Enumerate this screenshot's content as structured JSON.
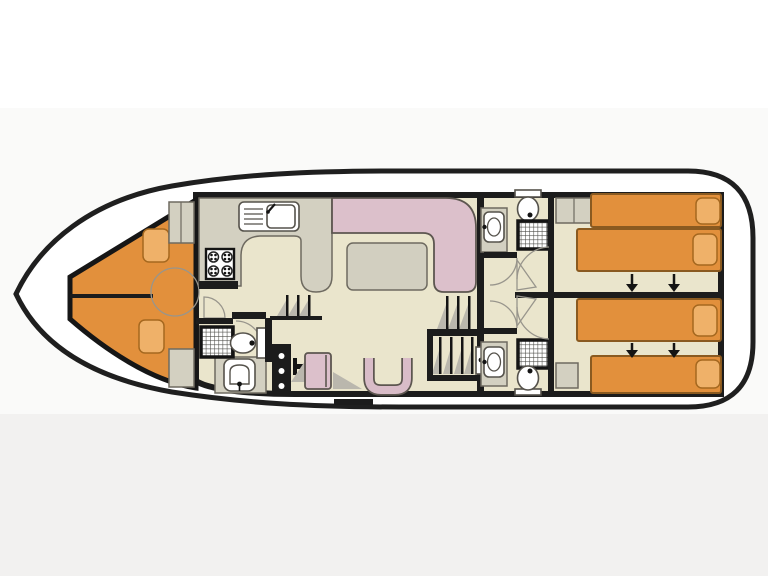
{
  "diagram": {
    "type": "houseboat-floor-plan",
    "orientation": "bow-left-stern-right",
    "rooms": [
      {
        "name": "bow-deck"
      },
      {
        "name": "bow-cabin",
        "beds": 2
      },
      {
        "name": "galley"
      },
      {
        "name": "forward-bathroom"
      },
      {
        "name": "saloon"
      },
      {
        "name": "helm-station"
      },
      {
        "name": "aft-stairs"
      },
      {
        "name": "aft-cabin-top",
        "beds": 2
      },
      {
        "name": "aft-cabin-bottom",
        "beds": 2
      },
      {
        "name": "aft-bathroom-top"
      },
      {
        "name": "aft-bathroom-bottom"
      },
      {
        "name": "stern-deck"
      }
    ],
    "fixtures": {
      "showers": 3,
      "toilets": 3,
      "washbasins": 3,
      "galley_sink": 1,
      "stove_burners": 4,
      "staircases": 2,
      "bed_slide_arrows": 4,
      "wardrobes": 4
    }
  },
  "colors": {
    "page_bg": "#ffffff",
    "band_mid": "#fafaf9",
    "band_bottom": "#f2f1f0",
    "deck": "#ffffff",
    "wall": "#1c1c1c",
    "floor": "#eae5cc",
    "cabin_orange": "#e2903c",
    "pillow_orange": "#efb169",
    "upholstery_pink": "#dcc0cb",
    "counter": "#d3d0c1",
    "table": "#d2cfc0",
    "step_shadow": "#bab7ad",
    "fixture_fill": "#ffffff",
    "door_leaf": "#f7f4e6"
  }
}
